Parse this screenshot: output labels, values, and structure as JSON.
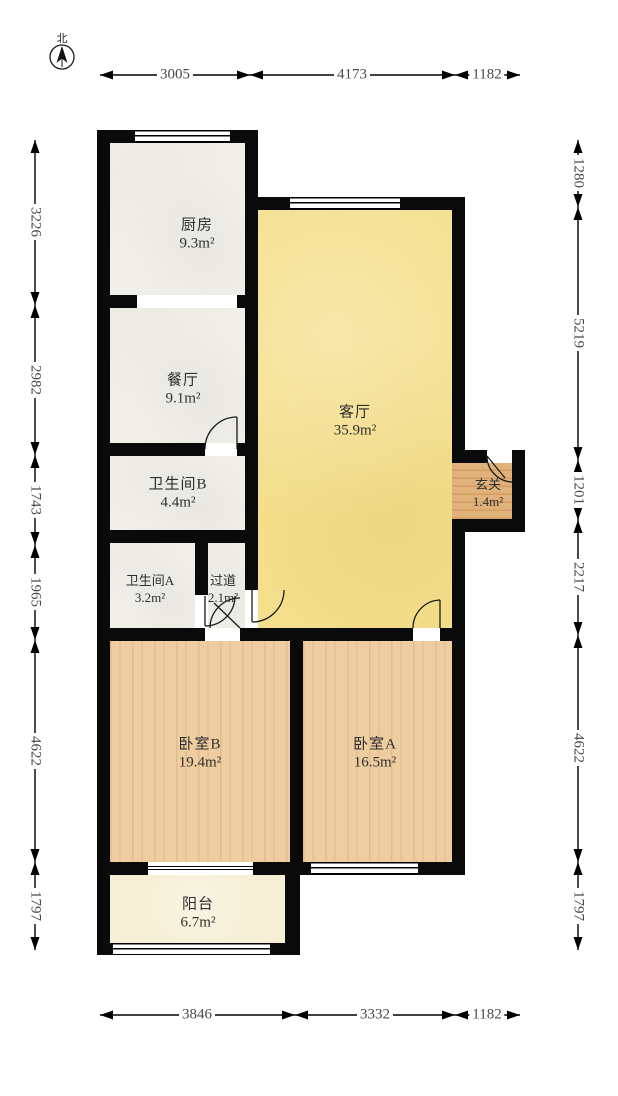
{
  "compass": {
    "north_label": "北"
  },
  "rooms": {
    "kitchen": {
      "name": "厨房",
      "area": "9.3m²"
    },
    "dining": {
      "name": "餐厅",
      "area": "9.1m²"
    },
    "living": {
      "name": "客厅",
      "area": "35.9m²"
    },
    "bathroom_b": {
      "name": "卫生间B",
      "area": "4.4m²"
    },
    "bathroom_a": {
      "name": "卫生间A",
      "area": "3.2m²"
    },
    "hallway": {
      "name": "过道",
      "area": "2.1m²"
    },
    "entry": {
      "name": "玄关",
      "area": "1.4m²"
    },
    "bedroom_b": {
      "name": "卧室B",
      "area": "19.4m²"
    },
    "bedroom_a": {
      "name": "卧室A",
      "area": "16.5m²"
    },
    "balcony": {
      "name": "阳台",
      "area": "6.7m²"
    }
  },
  "dimensions": {
    "top": [
      "3005",
      "4173",
      "1182"
    ],
    "bottom": [
      "3846",
      "3332",
      "1182"
    ],
    "left": [
      "3226",
      "2982",
      "1743",
      "1965",
      "4622",
      "1797"
    ],
    "right": [
      "1280",
      "5219",
      "1201",
      "2217",
      "4622",
      "1797"
    ]
  }
}
